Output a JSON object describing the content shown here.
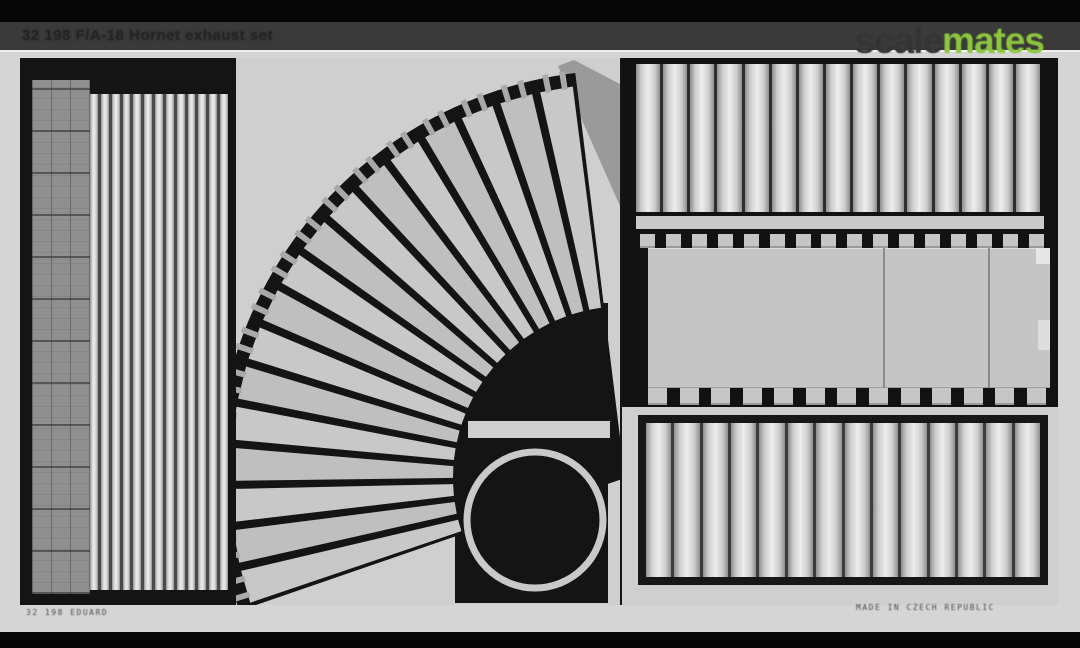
{
  "header": {
    "title": "32 198 F/A-18 Hornet exhaust set",
    "bar_color": "#3a3a3a"
  },
  "watermark": {
    "part1": "scale",
    "part2": "mates",
    "part1_color": "#343434",
    "part2_color": "#8cc63e"
  },
  "photo": {
    "subject": "photo-etched brass fret with exhaust nozzle parts",
    "border_color": "#d5d5d5",
    "metal_color": "#151515",
    "surface_color": "#cfcfcf",
    "etch_left": "32 198 EDUARD",
    "etch_right": "MADE IN CZECH REPUBLIC",
    "parts": {
      "left_louvre_panel": {
        "label": "slatted louvre panel with mesh edge",
        "strip_count": 13,
        "strip_color": "#d0d0d0",
        "gap_color": "#4a4a4a",
        "mesh_color": "#8f8f8f"
      },
      "nozzle_fan": {
        "label": "fan of tapered exhaust nozzle petals",
        "blade_count": 17,
        "angle_start": 97,
        "angle_end": 199,
        "center_x": 389,
        "center_y": 420,
        "outer_radius": 395,
        "inner_radius": 172,
        "band_radius": 408,
        "blade_color": "#c8c8c8",
        "blade_color_alt": "#bfbfbf",
        "wedge_color": "#9a9a9a"
      },
      "retainer_bar": {
        "x": 232,
        "y": 363,
        "w": 142,
        "h": 17,
        "color": "#cfcfcf"
      },
      "exhaust_ring": {
        "cx": 299,
        "cy": 462,
        "radius": 68,
        "stroke_width": 7,
        "color": "#c9c9c9"
      },
      "top_right_panel": {
        "label": "slat panel",
        "strip_count": 15,
        "strip_color": "#d2d2d2",
        "gap_color": "#2e2e2e"
      },
      "center_right_plates": {
        "label": "large liner plates with attachment tabs",
        "sections": 3,
        "plate_color": "#c5c5c5",
        "tab_count_top": 16,
        "tab_count_bottom": 13,
        "divider_positions": [
          0.585,
          0.846
        ]
      },
      "bottom_right_panel": {
        "label": "framed slat panel",
        "strip_count": 14,
        "strip_color": "#d0d0d0",
        "gap_color": "#3c3c3c"
      }
    }
  }
}
